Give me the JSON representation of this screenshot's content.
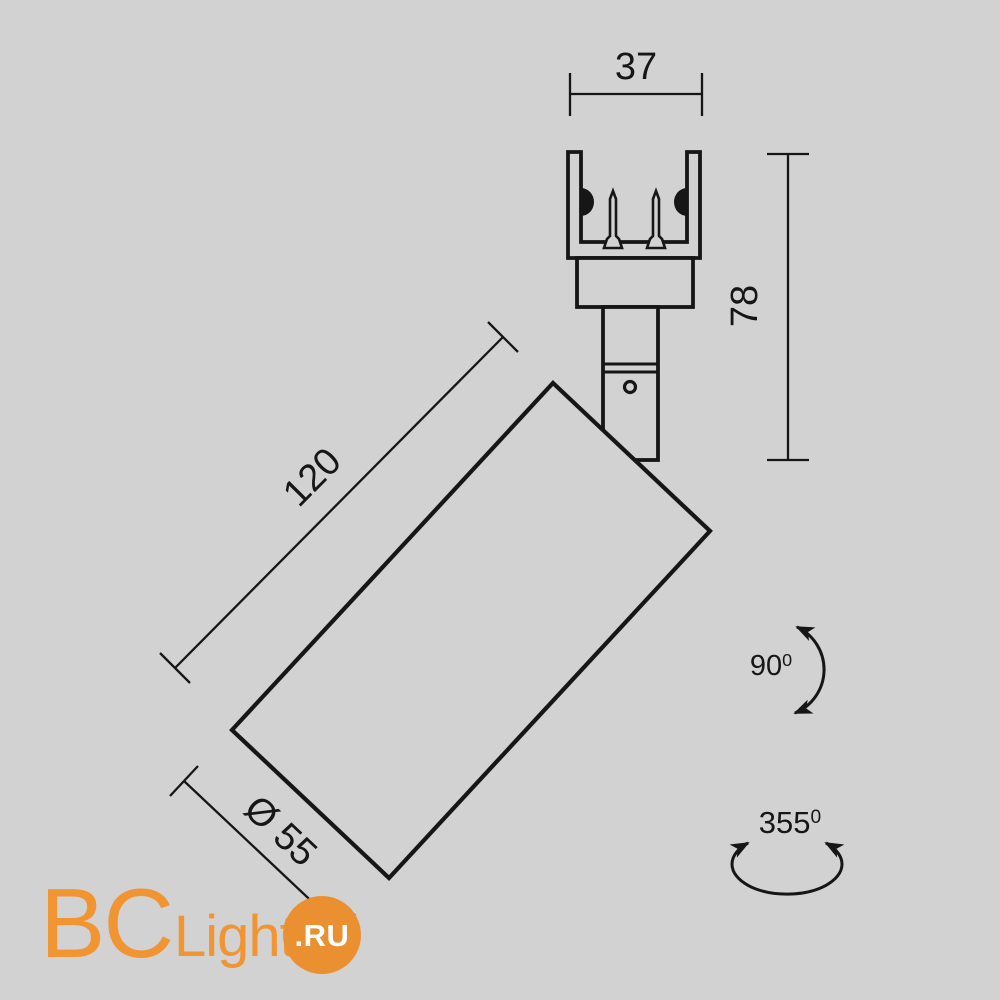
{
  "colors": {
    "background": "#d2d2d2",
    "line": "#161616",
    "logo_orange": "#f09532",
    "logo_circle": "#eb9030",
    "logo_suffix_text": "#ffffff"
  },
  "diagram": {
    "type": "product-dimension-drawing",
    "subject": "track-mounted spotlight, side view",
    "dimensions": {
      "track_adapter_width": "37",
      "mount_height": "78",
      "body_length": "120",
      "body_diameter": "Ø 55"
    },
    "angles": {
      "tilt": {
        "value": "90",
        "sup": "0"
      },
      "rotation": {
        "value": "355",
        "sup": "0"
      }
    }
  },
  "logo": {
    "part1": "BC",
    "part2": "Light",
    "suffix": ".RU"
  }
}
